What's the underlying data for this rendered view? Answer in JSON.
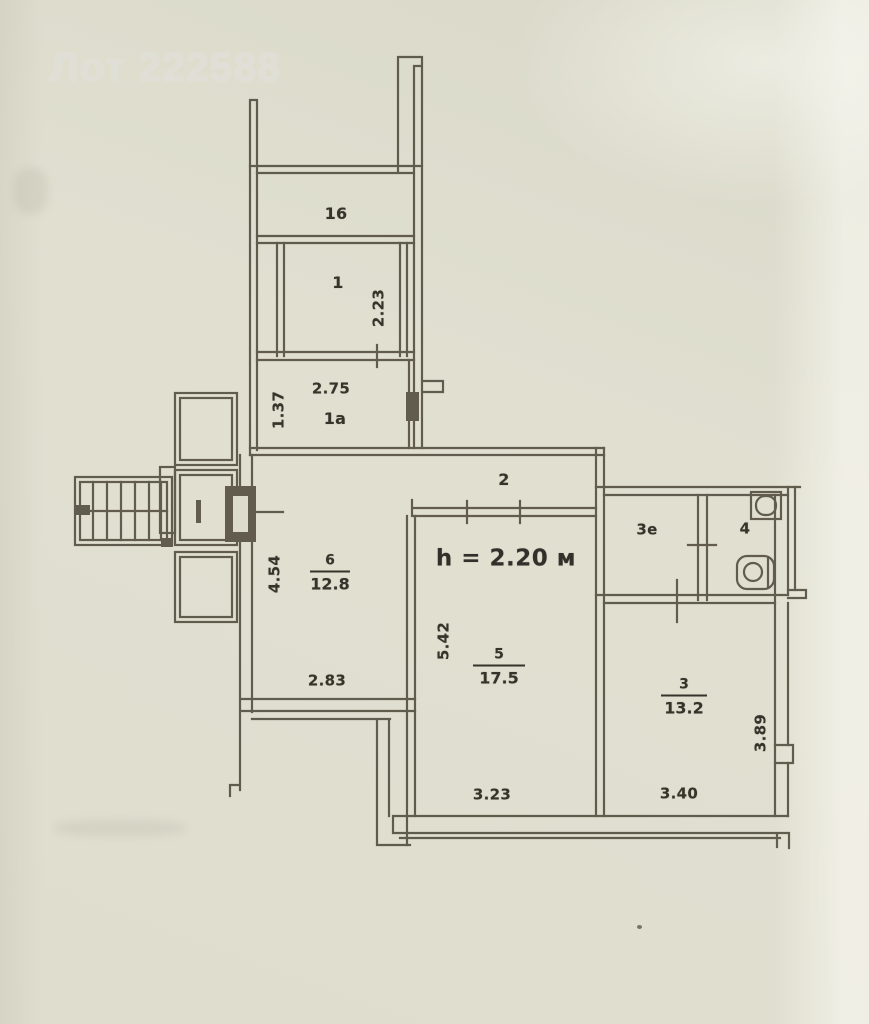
{
  "header": {
    "lot_label": "Лот 222588"
  },
  "plan": {
    "ceiling_height_note": "h = 2.20 м",
    "rooms": {
      "balcony": {
        "number": "16"
      },
      "room1": {
        "number": "1",
        "dim_v": "2.23"
      },
      "room1a": {
        "number": "1а",
        "dim_w": "2.75",
        "dim_v": "1.37"
      },
      "corridor": {
        "number": "2"
      },
      "room6": {
        "number": "6",
        "area": "12.8",
        "dim_v": "4.54",
        "dim_w": "2.83"
      },
      "room5": {
        "number": "5",
        "area": "17.5",
        "dim_v": "5.42",
        "dim_w": "3.23"
      },
      "room3e": {
        "number": "3е"
      },
      "room4": {
        "number": "4"
      },
      "room3": {
        "number": "3",
        "area": "13.2",
        "dim_w": "3.40",
        "dim_v": "3.89"
      }
    }
  },
  "colors": {
    "wall": "#4f4a3b",
    "label": "#36332a",
    "paper": "#dfdecf"
  }
}
